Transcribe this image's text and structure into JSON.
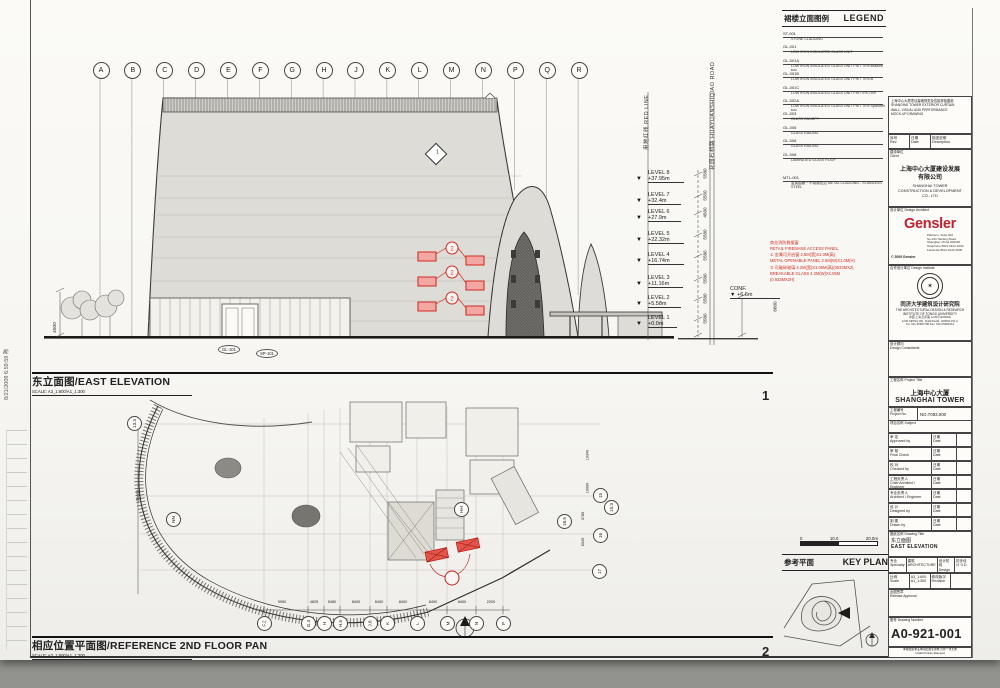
{
  "stamp": {
    "text": "8/21/2009 6:59:59 陈"
  },
  "elevation": {
    "title_zh": "东立面图/",
    "title_en": "EAST ELEVATION",
    "scale_note": "SCALE: A3_1:600/A1_1:300",
    "view_no": "1",
    "grid_letters": [
      "A",
      "B",
      "C",
      "D",
      "E",
      "F",
      "G",
      "H",
      "J",
      "K",
      "L",
      "M",
      "N",
      "P",
      "Q",
      "R"
    ],
    "levels": [
      {
        "name": "LEVEL 8",
        "elev": "+37.95m",
        "dim": "5580"
      },
      {
        "name": "LEVEL 7",
        "elev": "+32.4m",
        "dim": "5550"
      },
      {
        "name": "LEVEL 6",
        "elev": "+27.9m",
        "dim": "4500"
      },
      {
        "name": "LEVEL 5",
        "elev": "+22.32m",
        "dim": "5580"
      },
      {
        "name": "LEVEL 4",
        "elev": "+16.74m",
        "dim": "5580"
      },
      {
        "name": "LEVEL 3",
        "elev": "+11.16m",
        "dim": "5580"
      },
      {
        "name": "LEVEL 2",
        "elev": "+5.58m",
        "dim": "5580"
      },
      {
        "name": "LEVEL 1",
        "elev": "+0.0m",
        "dim": "5580"
      }
    ],
    "conf_label": "CONF.",
    "conf_elev": "+6.6m",
    "conf_dim": "6600",
    "red_line_label": "用地红线 RED LINE",
    "road_label": "花园石桥路 HUAYUANSHIQIAO ROAD",
    "left_dim": "4500",
    "detail_marker_no": "1",
    "tags": {
      "t1": "GL-101",
      "t2": "SP-101"
    },
    "panel_marker": "2"
  },
  "plan": {
    "title_zh": "相应位置平面图/",
    "title_en": "REFERENCE 2ND FLOOR PAN",
    "scale_note": "SCALE: A3_1:600/A1_1:300",
    "view_no": "2",
    "grid_bottom": [
      "F.2",
      "G.4",
      "H",
      "H.5",
      "J.8",
      "K",
      "L",
      "M",
      "N",
      "P"
    ],
    "dims_bottom": [
      "9950",
      "4825",
      "5480",
      "8400",
      "8400",
      "8400",
      "8400",
      "8400",
      "2200"
    ],
    "grid_left": "13.3",
    "left_dim": "36000",
    "bubble_nn": "NN",
    "bubble_hh": "HH",
    "grid_right": [
      "15",
      "15.3",
      "16.5",
      "16",
      "17"
    ],
    "dims_right": [
      "10340",
      "10000",
      "3785",
      "6345"
    ],
    "red_marker": "2",
    "north_no": "1"
  },
  "legend": {
    "title_zh": "裙楼立面图例",
    "title_en": "LEGEND",
    "items": [
      {
        "code": "ST-001",
        "desc": "STONE CLADDING"
      },
      {
        "code": "GL-001",
        "desc": "LOW IRON INSULATED GLASS UNIT"
      },
      {
        "code": "GL-001A",
        "desc": "LOW IRON INSULATED GLASS UNIT FRIT 70% shadow box"
      },
      {
        "code": "GL-001B",
        "desc": "LOW IRON INSULATED GLASS UNIT FRIT 70%-B"
      },
      {
        "code": "GL-001C",
        "desc": "LOW IRON INSULATED GLASS UNIT FRIT 0%-75%"
      },
      {
        "code": "GL-002A",
        "desc": "LOW IRON INSULATED GLASS UNIT FRIT 70% Spandrel box"
      },
      {
        "code": "GL-003",
        "desc": "GLASS CANOPY"
      },
      {
        "code": "GL-005",
        "desc": "GLASS RAILING"
      },
      {
        "code": "GL-006",
        "desc": "GLASS RAILING"
      },
      {
        "code": "GL-008",
        "desc": "LAMINATED GLASS ROOF"
      },
      {
        "code": "MTL-001",
        "desc": "金属围蔽－不锈钢包边  METAL CLADDING - STAINLESS STEEL"
      }
    ]
  },
  "red_note": {
    "lines": [
      "商业消防救援窗",
      "RETAIL FIREMANS ACCESS PANEL,",
      "① 金属可开启窗 2.5M(宽)X1.0M(高)",
      "METAL OPENABLE PANEL 2.5M(W)X1.0M(H)",
      "② 可破碎玻璃 4.2M(宽)X1.05M(高)(0533MX2)",
      "BREAKABLE GLASS 4.2M(W)X1.05M",
      "(0.933MX2H)"
    ]
  },
  "titleblock": {
    "stamp_lines": [
      "上海中心大厦项目幕墙视觉及性能样板图纸",
      "SHANGHAI TOWER EXTERIOR CURTAIN",
      "WALL, VISUAL AND PERFORMANCE",
      "MOCK-UP DRAWING"
    ],
    "rev_zh": "序号",
    "rev_en": "Rev.",
    "date_zh": "日期",
    "date_en": "Date",
    "desc_zh": "描述说明",
    "desc_en": "Description",
    "client_label_zh": "建设单位",
    "client_label_en": "Client",
    "client_zh1": "上海中心大厦建设发展",
    "client_zh2": "有限公司",
    "client_en_lines": [
      "SHANGHAI TOWER",
      "CONSTRUCTION & DEVELOPMENT",
      "CO., LTD"
    ],
    "arch_label_zh": "设计单位",
    "arch_label_en": "Design Architect",
    "arch_logo": "Gensler",
    "arch_addr_lines": [
      "Platinum, Suite 602",
      "No.233 Taicang Road",
      "Shanghai, China  200020",
      "Telephone 8621.6122.2400",
      "Facsimile 8621.6122.2500"
    ],
    "arch_copyright": "© 2009 Gensler",
    "inst_label_zh": "合作设计单位",
    "inst_label_en": "Design Institute",
    "inst_seal_glyph": "✶",
    "inst_zh": "同济大学建筑设计研究院",
    "inst_en1": "THE ARCHITECTURAL DESIGN & RESEARCH",
    "inst_en2": "INSTITUTE OF TONGJI UNIVERSITY",
    "inst_ad1": "中国 上海 四平路 1239号(200092)",
    "inst_ad2": "1239 SIPING RD. SHANGHAI, 200092 P.R.C",
    "inst_ad3": "Tel: 021-65987788  Fax: 021-65982414",
    "cons_zh": "设计顾问",
    "cons_en": "Design Consultants",
    "proj_label_zh": "工程名称",
    "proj_label_en": "Project Title",
    "proj_zh": "上海中心大厦",
    "proj_en": "SHANGHAI TOWER",
    "pno_zh": "工程编号",
    "pno_en": "Project No.",
    "pno_val": "NO.7093.000",
    "subj_zh": "项目名称",
    "subj_en": "Subject",
    "signoff": [
      {
        "zh": "审 定",
        "en": "Approved by",
        "dzh": "日期",
        "den": "Date"
      },
      {
        "zh": "审 核",
        "en": "Final Check",
        "dzh": "日期",
        "den": "Date"
      },
      {
        "zh": "校 对",
        "en": "Checked by",
        "dzh": "日期",
        "den": "Date"
      },
      {
        "zh": "工程负责人",
        "en": "Chief Architect / Engineer",
        "dzh": "日期",
        "den": "Date"
      },
      {
        "zh": "专业负责人",
        "en": "Architect / Engineer",
        "dzh": "日期",
        "den": "Date"
      },
      {
        "zh": "设 计",
        "en": "Designed by",
        "dzh": "日期",
        "den": "Date"
      },
      {
        "zh": "制 图",
        "en": "Drawn by",
        "dzh": "日期",
        "den": "Date"
      }
    ],
    "dtit_label_zh": "图纸名称",
    "dtit_label_en": "Drawing Title",
    "dtit_zh": "东立面图",
    "dtit_en": "EAST ELEVATION",
    "spec_zh": "专业",
    "spec_en": "Specialty",
    "spec_val_zh": "建筑",
    "spec_val_en": "ARCHITECTURE",
    "stage_zh": "设计阶段",
    "stage_en": "Design Stage",
    "stage_val": "初步设计 S.D.",
    "scale_zh": "比例",
    "scale_en": "Scale",
    "scale_v1": "A3_1:600",
    "scale_v2": "A1_1:300",
    "revlab_zh": "修改版次",
    "revlab_en": "Revision",
    "rel_zh": "出图签章",
    "rel_en": "Release Approval",
    "no_zh": "图号",
    "no_en": "Drawing Number",
    "dwg_no": "A0-921-001",
    "note_zh": "本图纸如未盖本院出图专用章,否则一律无效",
    "note_en": "Invalid Unless Stamped"
  },
  "keyplan": {
    "title_zh": "参考平面",
    "title_en": "KEY PLAN",
    "scale_ticks": [
      "0",
      "10.0",
      "20.0m"
    ]
  }
}
